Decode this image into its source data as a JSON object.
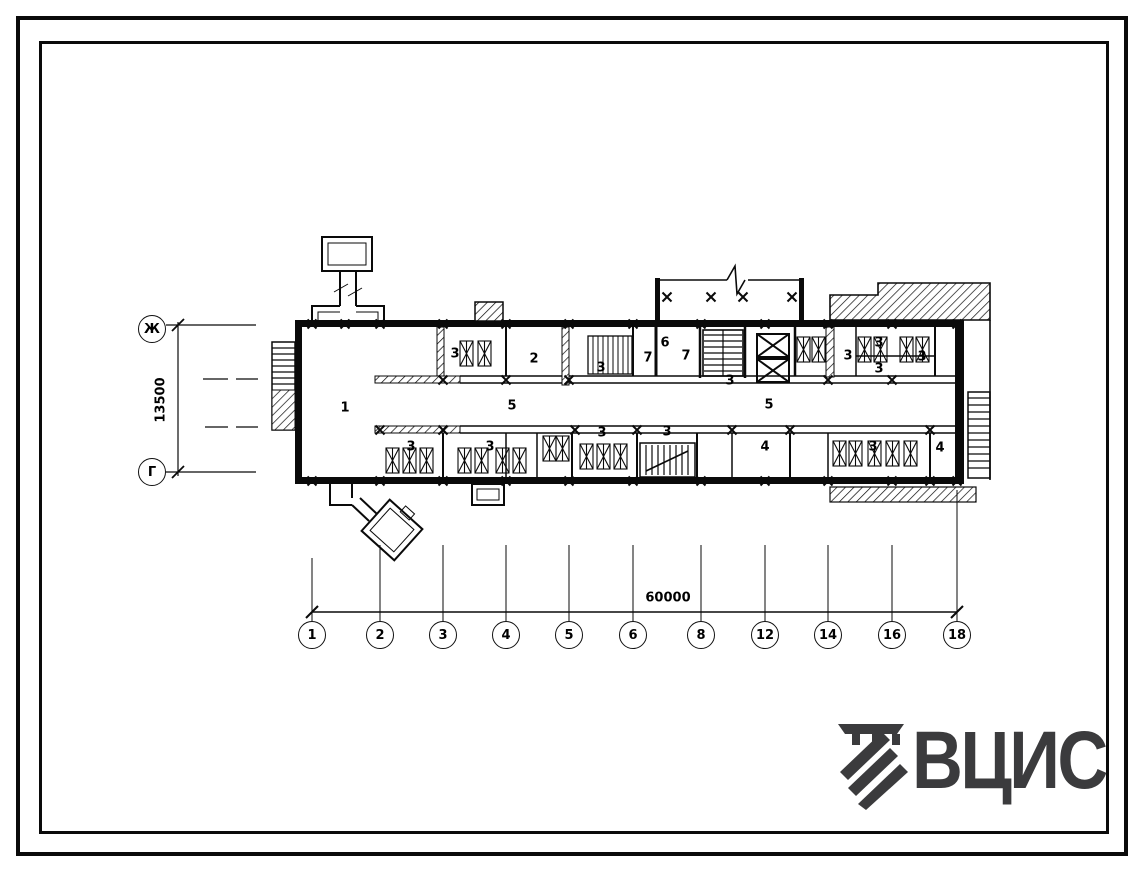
{
  "sheet": {
    "background": "#ffffff",
    "line_color": "#0a0a0a",
    "logo": {
      "text": "ВЦИС",
      "color": "#3b3b3d"
    }
  },
  "drawing": {
    "left_axis": {
      "top_label": "Ж",
      "bottom_label": "Г",
      "dimension": "13500"
    },
    "bottom_axis": {
      "labels": [
        "1",
        "2",
        "3",
        "4",
        "5",
        "6",
        "8",
        "12",
        "14",
        "16",
        "18"
      ],
      "dimension": "60000"
    },
    "room_labels": [
      {
        "t": "1",
        "x": 345,
        "y": 408
      },
      {
        "t": "3",
        "x": 455,
        "y": 354
      },
      {
        "t": "2",
        "x": 534,
        "y": 359
      },
      {
        "t": "5",
        "x": 512,
        "y": 406
      },
      {
        "t": "3",
        "x": 411,
        "y": 447
      },
      {
        "t": "3",
        "x": 490,
        "y": 447
      },
      {
        "t": "3",
        "x": 601,
        "y": 368
      },
      {
        "t": "6",
        "x": 665,
        "y": 343
      },
      {
        "t": "7",
        "x": 648,
        "y": 358
      },
      {
        "t": "7",
        "x": 686,
        "y": 356
      },
      {
        "t": "3",
        "x": 730,
        "y": 381
      },
      {
        "t": "5",
        "x": 769,
        "y": 405
      },
      {
        "t": "3",
        "x": 602,
        "y": 433
      },
      {
        "t": "3",
        "x": 667,
        "y": 432
      },
      {
        "t": "4",
        "x": 765,
        "y": 447
      },
      {
        "t": "3",
        "x": 848,
        "y": 356
      },
      {
        "t": "3",
        "x": 879,
        "y": 343
      },
      {
        "t": "3",
        "x": 879,
        "y": 369
      },
      {
        "t": "3",
        "x": 922,
        "y": 357
      },
      {
        "t": "3",
        "x": 873,
        "y": 447
      },
      {
        "t": "4",
        "x": 940,
        "y": 448
      }
    ]
  }
}
